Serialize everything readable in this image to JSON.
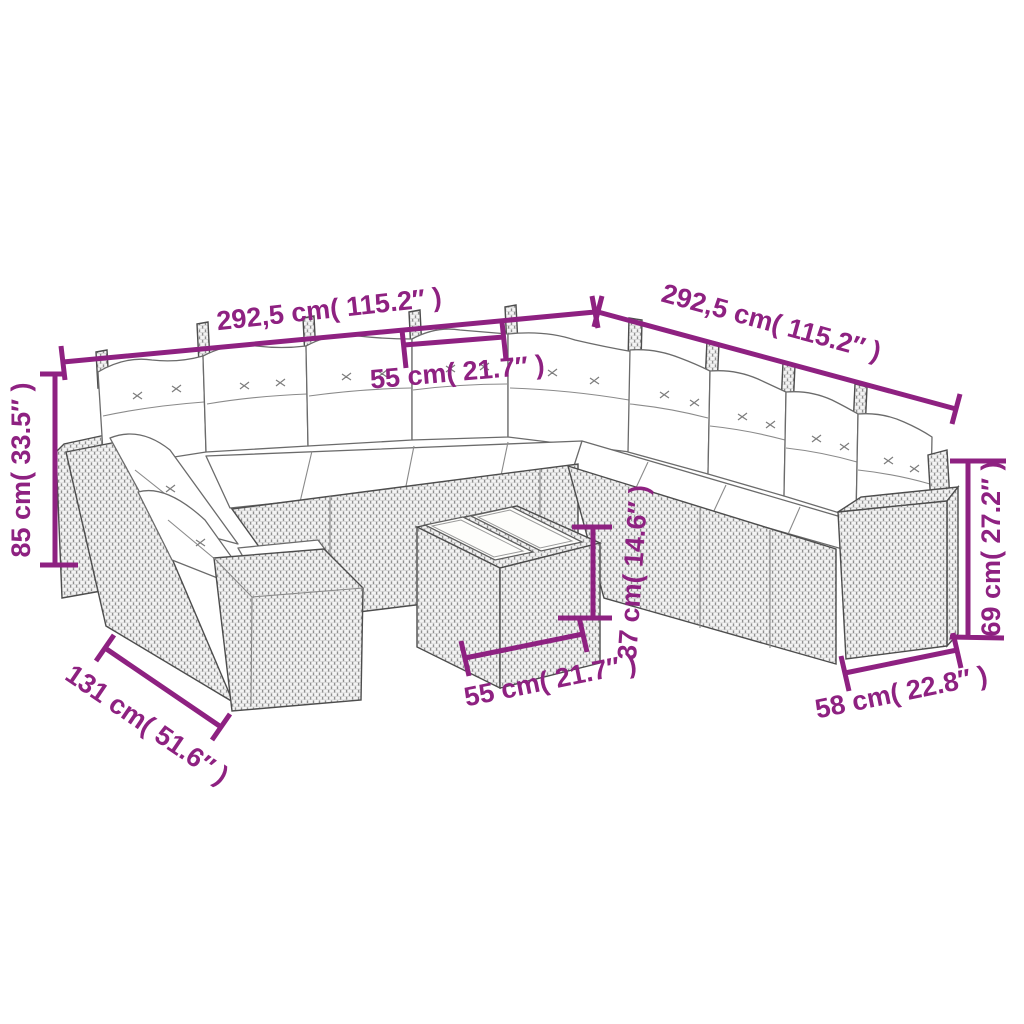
{
  "figure": {
    "type": "product-dimension-diagram",
    "subject": "rattan garden lounge sofa set with cushions and tray table",
    "accent_color": "#8e2181",
    "dimensions": {
      "left_back_width": "292,5 cm( 115.2″ )",
      "right_back_width": "292,5 cm( 115.2″ )",
      "seat_width": "55 cm( 21.7″ )",
      "back_height": "85 cm( 33.5″ )",
      "corner_section_depth": "131 cm( 51.6″ )",
      "table_width": "55 cm( 21.7″ )",
      "table_height": "37 cm( 14.6″ )",
      "arm_height": "69 cm( 27.2″ )",
      "end_section_depth": "58 cm( 22.8″ )"
    }
  }
}
